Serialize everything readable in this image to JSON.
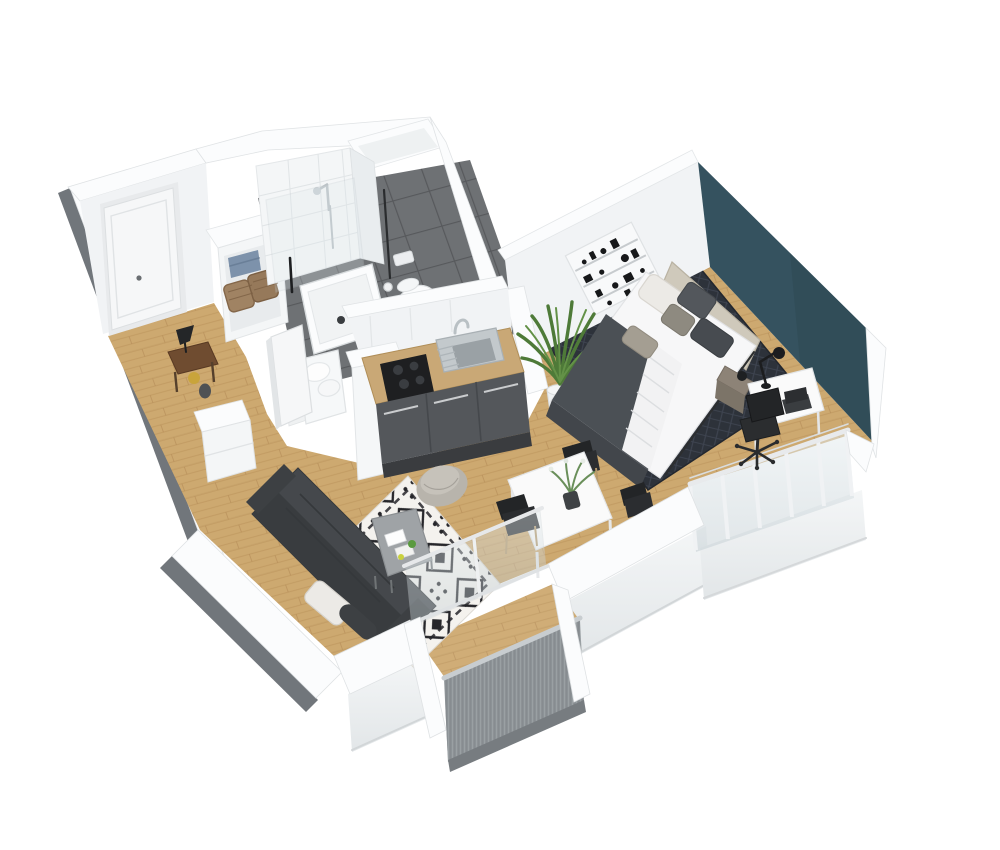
{
  "meta": {
    "title": "3D isometric apartment floor plan",
    "view": "axonometric cutaway, white background",
    "width_px": 1000,
    "height_px": 850
  },
  "palette": {
    "background": "#ffffff",
    "wall_top": "#fbfcfd",
    "wall_face": "#f1f3f5",
    "wall_face_shaded": "#e6e9eb",
    "wall_outer_edge": "#71767b",
    "floor_wood": "#cda970",
    "floor_wood_line": "#b68d55",
    "bathroom_tile": "#6e7174",
    "bathroom_grout": "#57595c",
    "accent_teal": "#35525f",
    "accent_teal_shade": "#2e4852",
    "rug_base": "#f4f2ee",
    "rug_pattern": "#26262a",
    "bedroom_rug_base": "#2d323a",
    "bedroom_rug_line": "#3e4450",
    "sofa": "#45484c",
    "sofa_dark": "#393c3f",
    "pillow_white": "#eceae6",
    "bed_white": "#f7f7f8",
    "bed_blanket": "#4b5055",
    "headboard": "#cfc9bb",
    "kitchen_cabinet": "#54575b",
    "counter_wood": "#c9a876",
    "cooktop_black": "#1e1f21",
    "sink_steel": "#c3c9cc",
    "plant_green": "#4e7a38",
    "railing_gray": "#9aa0a3",
    "glass_tint": "#cdd8dd",
    "table_white": "#fafafa",
    "chair_black": "#232527",
    "console_wood": "#6f4c30",
    "basket_wicker": "#a08363",
    "towel_blue": "#7d92ab",
    "door_white": "#f6f7f8",
    "nightstand_taupe": "#8d8377",
    "accent_yellow": "#c9a43b",
    "pouf_gray": "#b8b4ac"
  },
  "rooms": [
    {
      "name": "Entrance hallway",
      "items": [
        "entrance door",
        "console table",
        "table lamp",
        "shoe cabinet",
        "open wardrobe with baskets"
      ]
    },
    {
      "name": "Bathroom",
      "items": [
        "walk-in tiled shower",
        "shower tray",
        "toilet",
        "laundry baskets",
        "round pouf",
        "bathroom door"
      ]
    },
    {
      "name": "Kitchen",
      "items": [
        "wood counter",
        "sink with faucet",
        "black cooktop",
        "gray cabinet fronts",
        "tall cabinet column"
      ]
    },
    {
      "name": "Living room",
      "items": [
        "dark gray sofa",
        "white cushion",
        "black-and-white moroccan rug",
        "gray coffee table",
        "round pouf"
      ]
    },
    {
      "name": "Dining area",
      "items": [
        "white dining table",
        "black chairs",
        "small plant"
      ]
    },
    {
      "name": "Bedroom",
      "items": [
        "double bed",
        "headboard panel",
        "pillows",
        "dark patterned rug",
        "nightstand",
        "white desk",
        "desk lamp",
        "laptop",
        "black office chair",
        "wall shelf art",
        "potted palm",
        "teal accent wall"
      ]
    },
    {
      "name": "South balcony",
      "items": [
        "sliding glass door",
        "ribbed gray railing",
        "wood deck"
      ]
    },
    {
      "name": "Glazed facade",
      "items": [
        "floor-to-ceiling window wall",
        "window posts"
      ]
    }
  ]
}
